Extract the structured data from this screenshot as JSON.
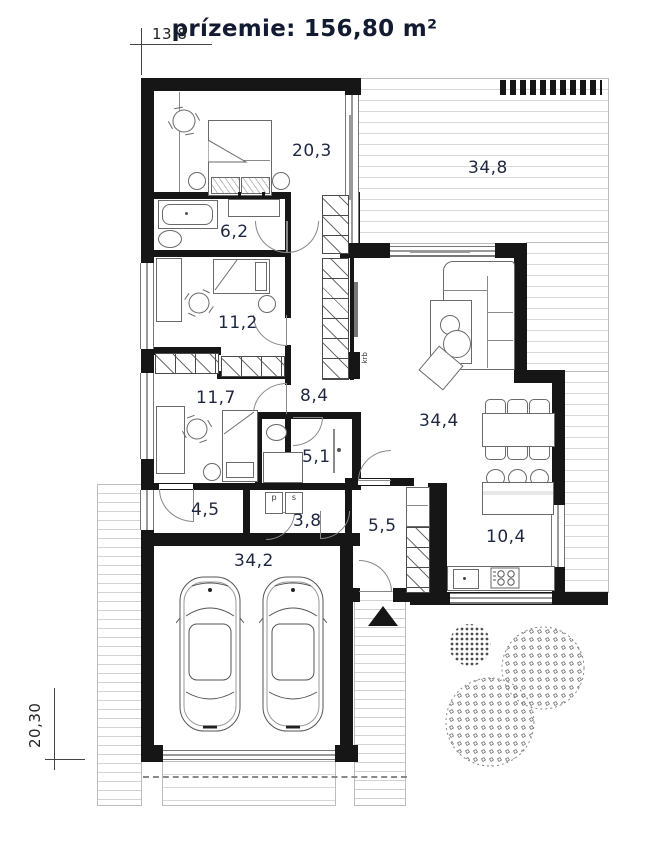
{
  "title": "prízemie: 156,80 m²",
  "dimensions": {
    "width_top": "13,8",
    "depth_left": "20,30"
  },
  "rooms": {
    "master_bedroom": "20,3",
    "terrace": "34,8",
    "bathroom": "6,2",
    "bedroom_2": "11,2",
    "bedroom_3": "11,7",
    "hall": "8,4",
    "living_room": "34,4",
    "shower_room": "5,1",
    "storage": "4,5",
    "utility": "3,8",
    "entry": "5,5",
    "kitchen": "10,4",
    "garage": "34,2"
  },
  "annotations": {
    "fireplace": "krb",
    "washer": "p",
    "dryer": "s"
  },
  "colors": {
    "wall": "#161616",
    "label": "#1e2742",
    "deck_line": "#d8d8d8"
  }
}
